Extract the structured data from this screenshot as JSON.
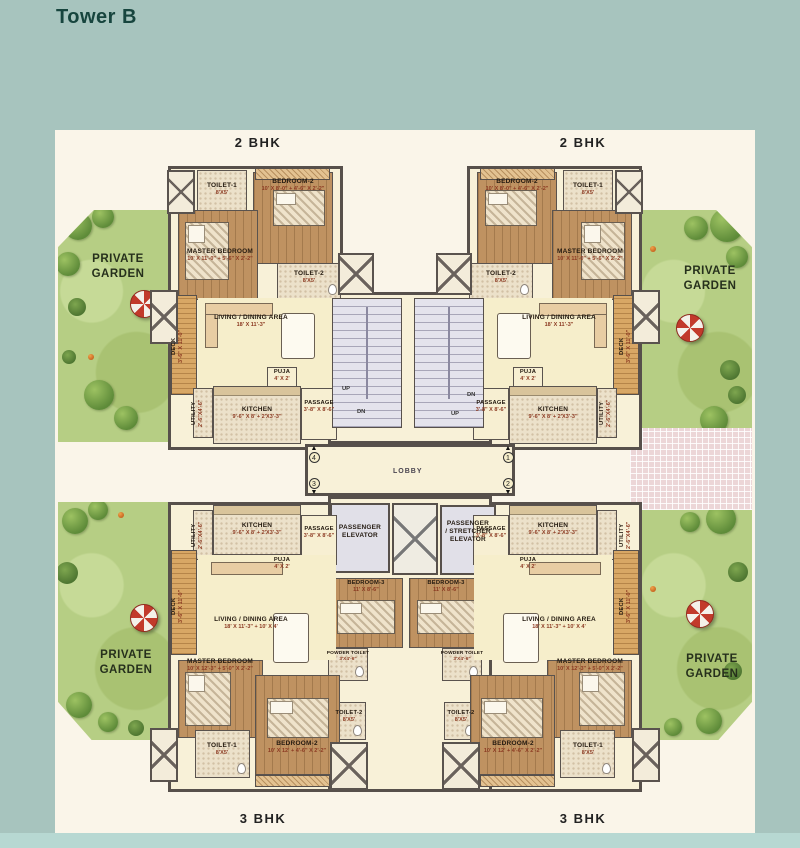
{
  "title": "Tower B",
  "unit_types": {
    "top_left": "2 BHK",
    "top_right": "2 BHK",
    "bottom_left": "3 BHK",
    "bottom_right": "3 BHK"
  },
  "garden": {
    "line1": "PRIVATE",
    "line2": "GARDEN"
  },
  "core": {
    "lobby": "LOBBY",
    "up": "UP",
    "dn": "DN",
    "elevator1": {
      "line1": "PASSENGER",
      "line2": "ELEVATOR"
    },
    "elevator2": {
      "line1": "PASSENGER",
      "line2": "/ STRETCHER",
      "line3": "ELEVATOR"
    },
    "markers": {
      "m1": "1",
      "m2": "2",
      "m3": "3",
      "m4": "4"
    }
  },
  "rooms_2bhk": {
    "master": {
      "name": "MASTER BEDROOM",
      "dim": "10' X 11'-0\" + 5'-6\" X 2'-2\""
    },
    "bedroom2": {
      "name": "BEDROOM-2",
      "dim": "10' X 8'-0\" + 4'-6\" X 2'-2\""
    },
    "toilet1": {
      "name": "TOILET-1",
      "dim": "8'X5'"
    },
    "toilet2": {
      "name": "TOILET-2",
      "dim": "8'X5'"
    },
    "living": {
      "name": "LIVING / DINING AREA",
      "dim": "18' X 11'-3\""
    },
    "kitchen": {
      "name": "KITCHEN",
      "dim": "9'-6\" X 8' + 2'X3'-3\""
    },
    "puja": {
      "name": "PUJA",
      "dim": "4' X 2'"
    },
    "passage": {
      "name": "PASSAGE",
      "dim": "3'-8\" X 8'-6\""
    },
    "utility": {
      "name": "UTILITY",
      "dim": "2'-6\"X4'-6\""
    },
    "deck": {
      "name": "DECK",
      "dim": "3'-6\" X 11'-0\""
    }
  },
  "rooms_3bhk": {
    "master": {
      "name": "MASTER BEDROOM",
      "dim": "10' X 12'-3\" + 5'-0\" X 2'-2\""
    },
    "bedroom2": {
      "name": "BEDROOM-2",
      "dim": "10' X 12' + 4'-6\" X 2'-2\""
    },
    "bedroom3": {
      "name": "BEDROOM-3",
      "dim": "11' X 8'-6\""
    },
    "toilet1": {
      "name": "TOILET-1",
      "dim": "8'X5'"
    },
    "toilet2": {
      "name": "TOILET-2",
      "dim": "8'X5'"
    },
    "powder": {
      "name": "POWDER TOILET",
      "dim": "3'X4'-6\""
    },
    "living": {
      "name": "LIVING / DINING AREA",
      "dim": "18' X 11'-3\" + 10' X 4'"
    },
    "kitchen": {
      "name": "KITCHEN",
      "dim": "9'-6\" X 8' + 2'X3'-3\""
    },
    "puja": {
      "name": "PUJA",
      "dim": "4' X 2'"
    },
    "passage": {
      "name": "PASSAGE",
      "dim": "3'-8\" X 8'-6\""
    },
    "utility": {
      "name": "UTILITY",
      "dim": "2'-6\"X4'-6\""
    },
    "deck": {
      "name": "DECK",
      "dim": "3'-6\" X 11'-0\""
    }
  },
  "colors": {
    "background_teal": "#a7c4be",
    "panel_cream": "#faf5e9",
    "wall_gray": "#57504b",
    "wood_floor": "#bf9261",
    "garden_green": "#b6ce84",
    "umbrella_red": "#c23a2b",
    "dimension_text": "#8c3a22",
    "tile_pink": "#ecd6d7"
  }
}
